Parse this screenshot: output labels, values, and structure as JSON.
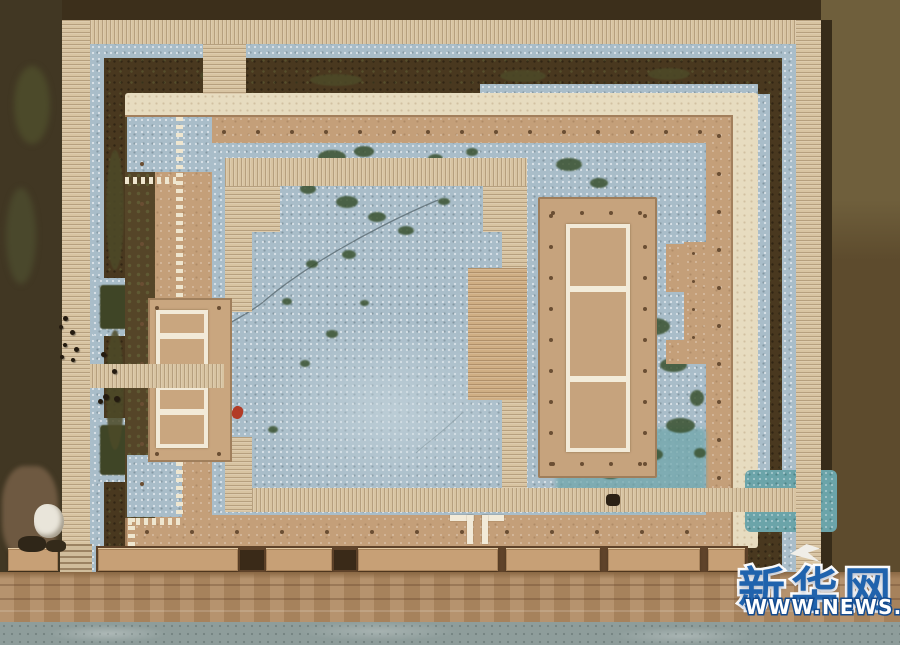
{
  "image": {
    "description": "Aerial top-down photograph of an excavated ancient palace foundation site with boardwalks, gravel courtyards and rammed-earth platforms",
    "width_px": 900,
    "height_px": 645
  },
  "watermark": {
    "logo_text": "新华网",
    "url_text": "WWW.NEWS.CN",
    "logo_color": "#2063ad",
    "url_outline_color": "#134a8e"
  },
  "palette": {
    "field_dark": "#46361f",
    "field_olive": "#6f5f3c",
    "boardwalk": "#d8c4a2",
    "walkway_cream": "#e7dcc0",
    "platform_tan": "#c49f79",
    "gravel_blue": "#a9bdc9",
    "gravel_teal": "#6ba4a9",
    "moss_green": "#3a5230",
    "ring_olive": "#4d4a28",
    "road": "#b08a62",
    "concrete": "#8e9d9b",
    "post_hole": "#6a4e33",
    "foundation_white": "#f2ead8"
  },
  "scene": {
    "moss_patches": [
      [
        318,
        150,
        28,
        14
      ],
      [
        354,
        146,
        20,
        11
      ],
      [
        428,
        154,
        15,
        9
      ],
      [
        466,
        148,
        12,
        8
      ],
      [
        300,
        184,
        16,
        10
      ],
      [
        336,
        196,
        22,
        12
      ],
      [
        368,
        212,
        18,
        10
      ],
      [
        398,
        226,
        16,
        9
      ],
      [
        438,
        198,
        12,
        7
      ],
      [
        488,
        168,
        10,
        6
      ],
      [
        342,
        250,
        14,
        9
      ],
      [
        306,
        260,
        12,
        8
      ],
      [
        282,
        298,
        10,
        7
      ],
      [
        326,
        330,
        12,
        8
      ],
      [
        300,
        360,
        10,
        7
      ],
      [
        268,
        426,
        10,
        7
      ],
      [
        360,
        300,
        9,
        6
      ],
      [
        556,
        158,
        26,
        13
      ],
      [
        590,
        178,
        18,
        10
      ],
      [
        544,
        298,
        14,
        8
      ],
      [
        556,
        338,
        12,
        8
      ],
      [
        638,
        318,
        32,
        17
      ],
      [
        660,
        358,
        27,
        14
      ],
      [
        628,
        388,
        22,
        12
      ],
      [
        666,
        418,
        29,
        15
      ],
      [
        638,
        448,
        25,
        13
      ],
      [
        600,
        468,
        21,
        11
      ],
      [
        574,
        430,
        14,
        9
      ],
      [
        690,
        390,
        14,
        16
      ],
      [
        694,
        448,
        12,
        10
      ],
      [
        200,
        68,
        44,
        15,
        "#4d4a28"
      ],
      [
        310,
        74,
        52,
        12,
        "#4d4a28"
      ],
      [
        500,
        70,
        46,
        12,
        "#4d4a28"
      ],
      [
        648,
        68,
        42,
        12,
        "#4d4a28"
      ],
      [
        106,
        150,
        18,
        120,
        "#4d4a28"
      ],
      [
        106,
        330,
        18,
        120,
        "#4d4a28"
      ]
    ],
    "people": [
      [
        63,
        316,
        5
      ],
      [
        59,
        325,
        4
      ],
      [
        70,
        330,
        5
      ],
      [
        63,
        343,
        4
      ],
      [
        74,
        347,
        5
      ],
      [
        60,
        355,
        4
      ],
      [
        71,
        358,
        4
      ],
      [
        101,
        352,
        5
      ],
      [
        112,
        369,
        5
      ],
      [
        103,
        394,
        6
      ],
      [
        114,
        396,
        6
      ],
      [
        98,
        399,
        5
      ]
    ],
    "wall_blocks": [
      [
        8,
        50
      ],
      [
        98,
        140
      ],
      [
        266,
        66
      ],
      [
        358,
        140
      ],
      [
        506,
        94
      ],
      [
        608,
        92
      ],
      [
        708,
        37
      ]
    ],
    "dot_rows": [
      {
        "x": 222,
        "y": 130,
        "dx": 34,
        "dy": 0,
        "n": 15,
        "s": 4
      },
      {
        "x": 140,
        "y": 162,
        "dx": 0,
        "dy": 40,
        "n": 9,
        "s": 4
      },
      {
        "x": 145,
        "y": 530,
        "dx": 45,
        "dy": 0,
        "n": 13,
        "s": 4
      },
      {
        "x": 717,
        "y": 134,
        "dx": 0,
        "dy": 38,
        "n": 10,
        "s": 4
      },
      {
        "x": 551,
        "y": 211,
        "dx": 29,
        "dy": 0,
        "n": 4,
        "s": 4
      },
      {
        "x": 551,
        "y": 462,
        "dx": 29,
        "dy": 0,
        "n": 4,
        "s": 4
      },
      {
        "x": 549,
        "y": 214,
        "dx": 0,
        "dy": 31,
        "n": 9,
        "s": 4
      },
      {
        "x": 643,
        "y": 214,
        "dx": 0,
        "dy": 31,
        "n": 9,
        "s": 4
      },
      {
        "x": 692,
        "y": 252,
        "dx": 0,
        "dy": 28,
        "n": 4,
        "s": 3
      },
      {
        "x": 155,
        "y": 306,
        "dx": 62,
        "dy": 0,
        "n": 2,
        "s": 4
      },
      {
        "x": 155,
        "y": 452,
        "dx": 62,
        "dy": 0,
        "n": 2,
        "s": 4
      }
    ]
  }
}
